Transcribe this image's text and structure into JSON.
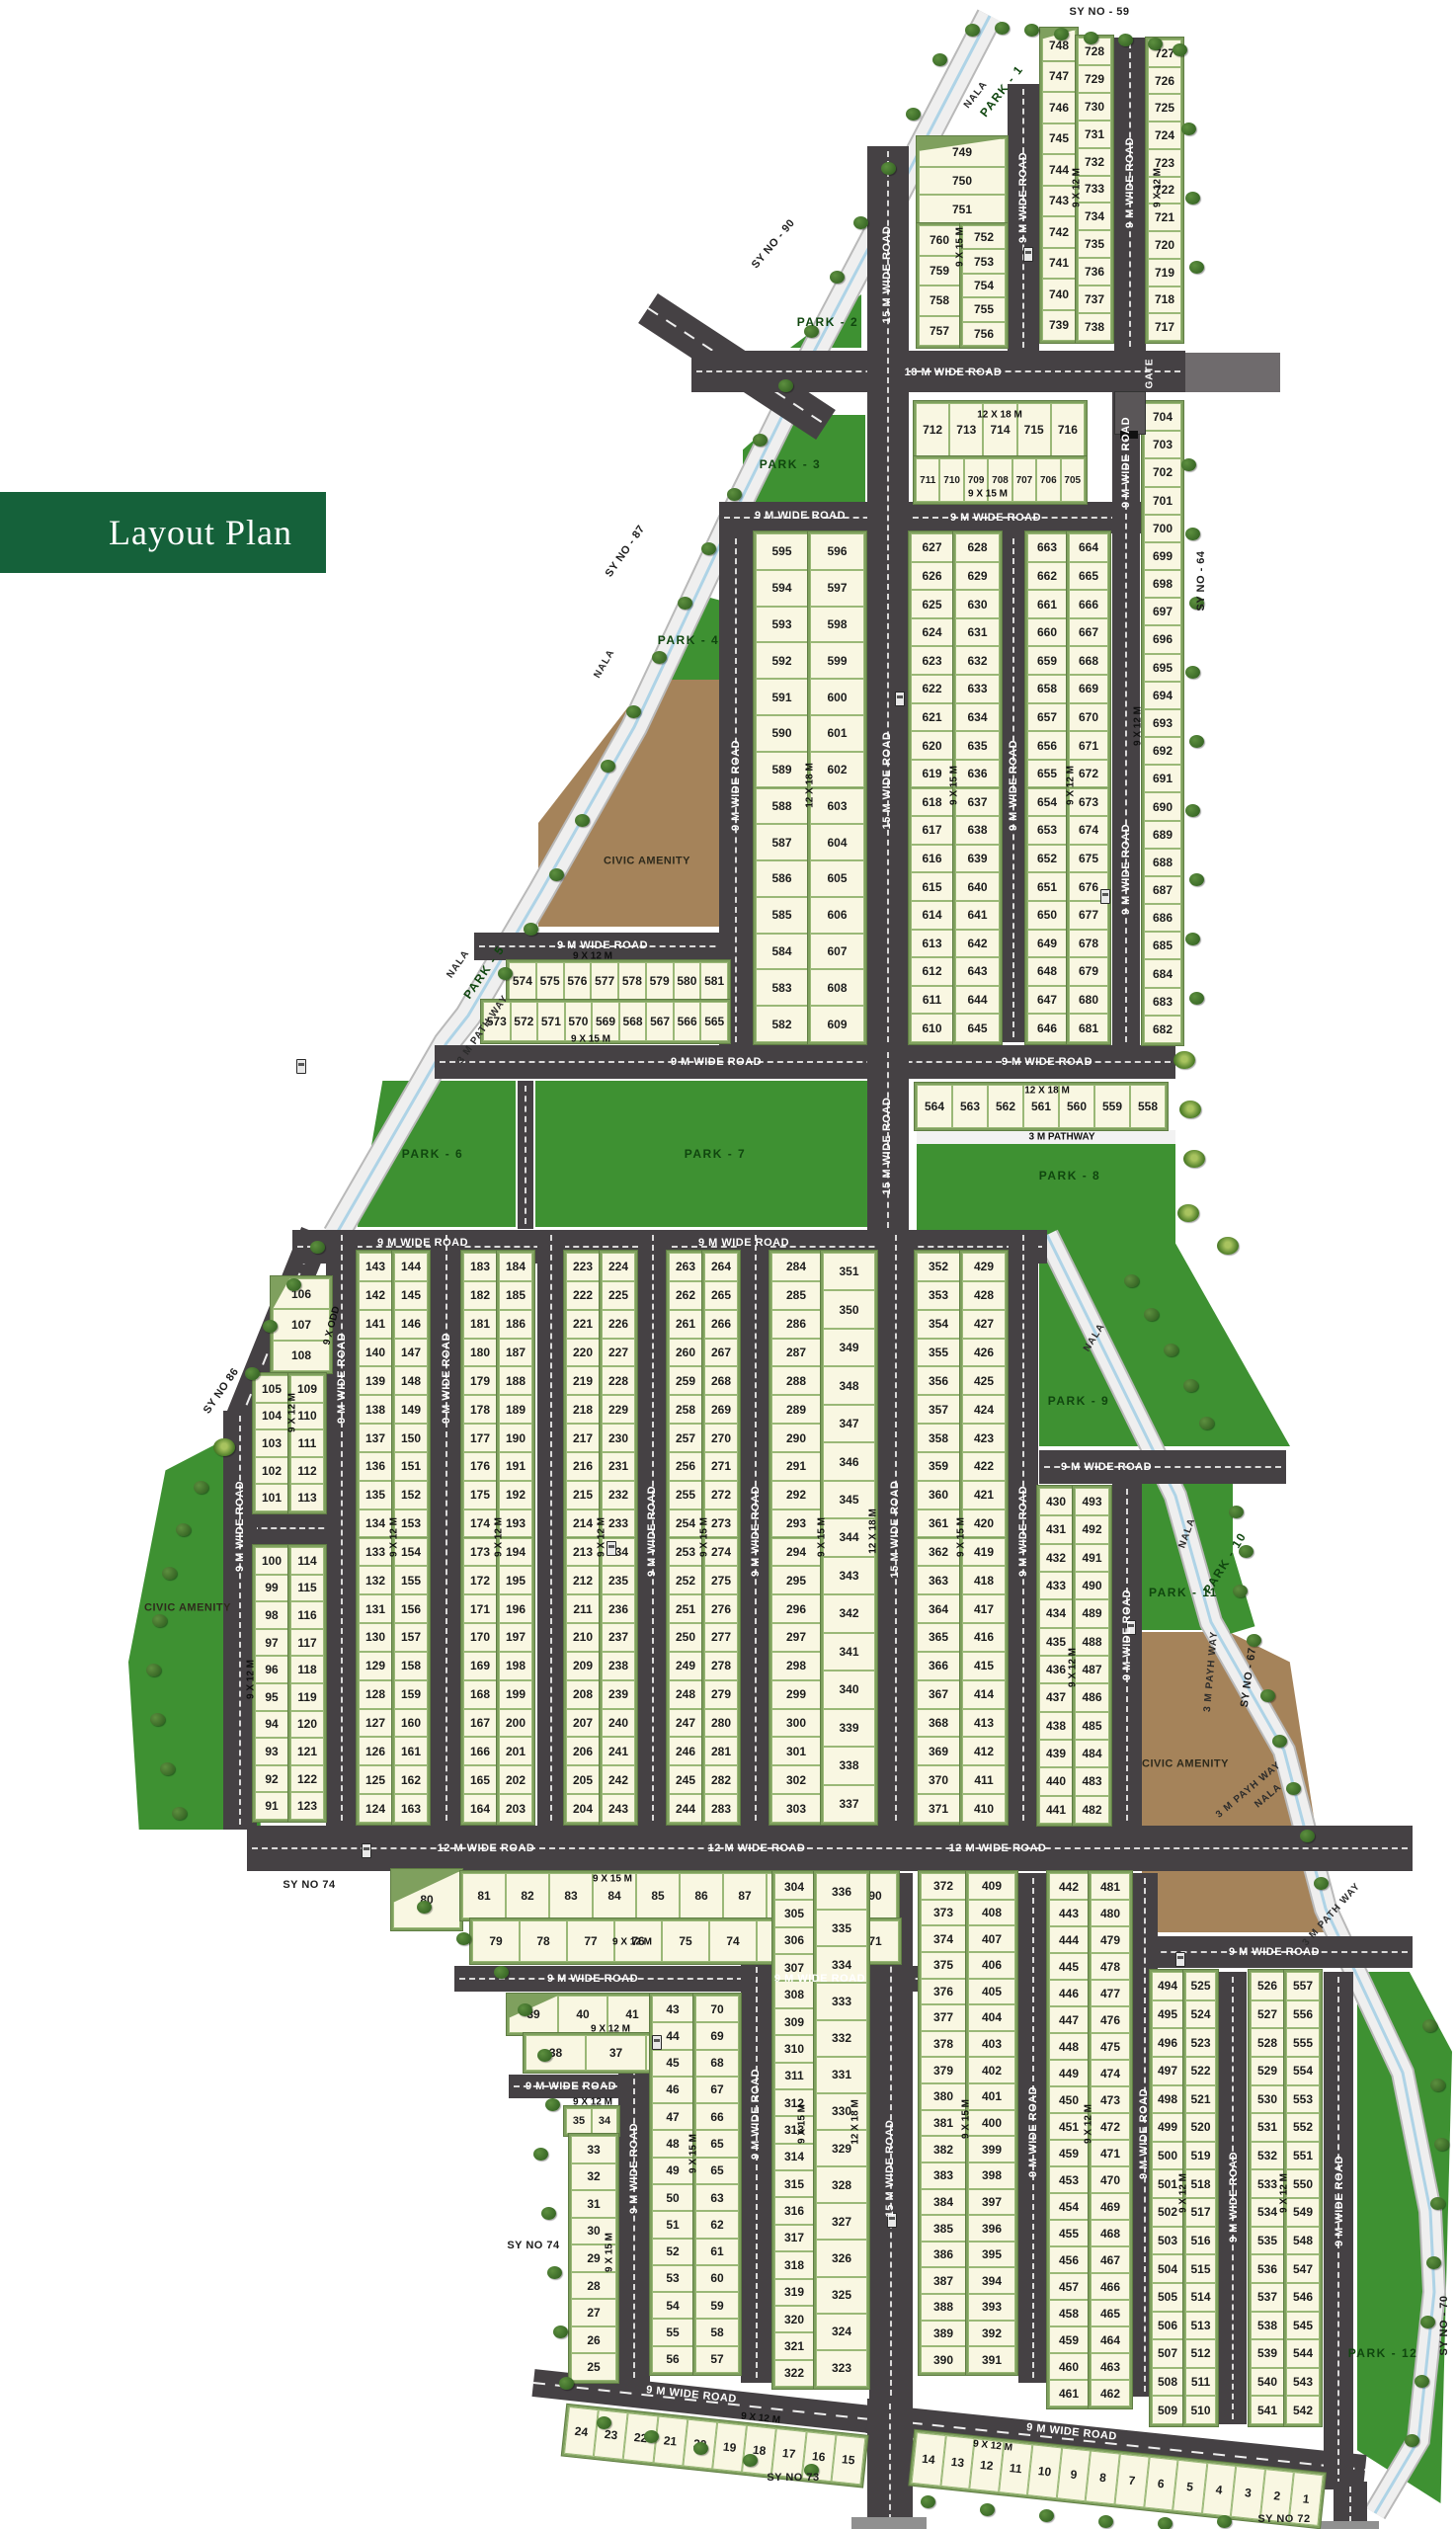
{
  "title": "Layout Plan",
  "roads": {
    "w9": "9 M WIDE ROAD",
    "w12": "12 M WIDE ROAD",
    "w15": "15 M WIDE ROAD",
    "w18": "18 M WIDE ROAD"
  },
  "dims": {
    "d912": "9 X 12 M",
    "d915": "9 X 15 M",
    "d1218": "12 X 18 M",
    "dodd": "9 X ODD"
  },
  "misc": {
    "gate": "GATE",
    "civic": "CIVIC AMENITY",
    "nala": "NALA",
    "pathway": "3 M PATHWAY",
    "pathway2": "3 M PATH WAY",
    "payh": "3 M PAYH WAY"
  },
  "parks": {
    "p1": "PARK - 1",
    "p2": "PARK - 2",
    "p3": "PARK - 3",
    "p4": "PARK - 4",
    "p5": "PARK - 5",
    "p6": "PARK - 6",
    "p7": "PARK - 7",
    "p8": "PARK - 8",
    "p9": "PARK - 9",
    "p10": "PARK - 10",
    "p11": "PARK - 11",
    "p12": "PARK - 12"
  },
  "survey": {
    "s59": "SY NO - 59",
    "s64": "SY NO - 64",
    "s67": "SY NO - 67",
    "s70": "SY NO - 70",
    "s72": "SY NO 72",
    "s73": "SY NO 73",
    "s74": "SY NO 74",
    "s86": "SY NO 86",
    "s87": "SY NO - 87",
    "s90": "SY NO - 90"
  },
  "blocks": {
    "b749": {
      "full": [
        749,
        750,
        751
      ],
      "left": [
        760,
        759,
        758,
        757
      ],
      "right": [
        752,
        753,
        754,
        755,
        756
      ]
    },
    "b728": {
      "left": [
        748,
        747,
        746,
        745,
        744,
        743,
        742,
        741,
        740,
        739
      ],
      "right": [
        728,
        729,
        730,
        731,
        732,
        733,
        734,
        735,
        736,
        737,
        738
      ]
    },
    "b717": {
      "col": [
        727,
        726,
        725,
        724,
        723,
        722,
        721,
        720,
        719,
        718,
        717
      ]
    },
    "b705": {
      "top": [
        712,
        713,
        714,
        715,
        716
      ],
      "bottom": [
        711,
        710,
        709,
        708,
        707,
        706,
        705
      ]
    },
    "b682": {
      "col": [
        704,
        703,
        702,
        701,
        700,
        699,
        698,
        697,
        696,
        695,
        694,
        693,
        692,
        691,
        690,
        689,
        688,
        687,
        686,
        685,
        684,
        683,
        682
      ]
    },
    "b582": {
      "left": [
        595,
        594,
        593,
        592,
        591,
        590,
        589,
        588,
        587,
        586,
        585,
        584,
        583,
        582
      ],
      "right": [
        596,
        597,
        598,
        599,
        600,
        601,
        602,
        603,
        604,
        605,
        606,
        607,
        608,
        609
      ]
    },
    "b610": {
      "left": [
        627,
        626,
        625,
        624,
        623,
        622,
        621,
        620,
        619,
        618,
        617,
        616,
        615,
        614,
        613,
        612,
        611,
        610
      ],
      "right": [
        628,
        629,
        630,
        631,
        632,
        633,
        634,
        635,
        636,
        637,
        638,
        639,
        640,
        641,
        642,
        643,
        644,
        645
      ]
    },
    "b646": {
      "left": [
        663,
        662,
        661,
        660,
        659,
        658,
        657,
        656,
        655,
        654,
        653,
        652,
        651,
        650,
        649,
        648,
        647,
        646
      ],
      "right": [
        664,
        665,
        666,
        667,
        668,
        669,
        670,
        671,
        672,
        673,
        674,
        675,
        676,
        677,
        678,
        679,
        680,
        681
      ]
    },
    "b565": {
      "top": [
        574,
        575,
        576,
        577,
        578,
        579,
        580,
        581
      ],
      "bottom": [
        573,
        572,
        571,
        570,
        569,
        568,
        567,
        566,
        565
      ]
    },
    "b558": {
      "row": [
        564,
        563,
        562,
        561,
        560,
        559,
        558
      ]
    },
    "b101": {
      "wedge": [
        106,
        107,
        108
      ],
      "upL": [
        105,
        104,
        103,
        102,
        101
      ],
      "upR": [
        109,
        110,
        111,
        112,
        113
      ],
      "loL": [
        100,
        99,
        98,
        97,
        96,
        95,
        94,
        93,
        92,
        91
      ],
      "loR": [
        114,
        115,
        116,
        117,
        118,
        119,
        120,
        121,
        122,
        123
      ]
    },
    "b124": {
      "left": [
        143,
        142,
        141,
        140,
        139,
        138,
        137,
        136,
        135,
        134,
        133,
        132,
        131,
        130,
        129,
        128,
        127,
        126,
        125,
        124
      ],
      "right": [
        144,
        145,
        146,
        147,
        148,
        149,
        150,
        151,
        152,
        153,
        154,
        155,
        156,
        157,
        158,
        159,
        160,
        161,
        162,
        163
      ]
    },
    "b164": {
      "left": [
        183,
        182,
        181,
        180,
        179,
        178,
        177,
        176,
        175,
        174,
        173,
        172,
        171,
        170,
        169,
        168,
        167,
        166,
        165,
        164
      ],
      "right": [
        184,
        185,
        186,
        187,
        188,
        189,
        190,
        191,
        192,
        193,
        194,
        195,
        196,
        197,
        198,
        199,
        200,
        201,
        202,
        203
      ]
    },
    "b204": {
      "left": [
        223,
        222,
        221,
        220,
        219,
        218,
        217,
        216,
        215,
        214,
        213,
        212,
        211,
        210,
        209,
        208,
        207,
        206,
        205,
        204
      ],
      "right": [
        224,
        225,
        226,
        227,
        228,
        229,
        230,
        231,
        232,
        233,
        234,
        235,
        236,
        237,
        238,
        239,
        240,
        241,
        242,
        243
      ]
    },
    "b244": {
      "left": [
        263,
        262,
        261,
        260,
        259,
        258,
        257,
        256,
        255,
        254,
        253,
        252,
        251,
        250,
        249,
        248,
        247,
        246,
        245,
        244
      ],
      "right": [
        264,
        265,
        266,
        267,
        268,
        269,
        270,
        271,
        272,
        273,
        274,
        275,
        276,
        277,
        278,
        279,
        280,
        281,
        282,
        283
      ]
    },
    "b284": {
      "left": [
        284,
        285,
        286,
        287,
        288,
        289,
        290,
        291,
        292,
        293,
        294,
        295,
        296,
        297,
        298,
        299,
        300,
        301,
        302,
        303
      ],
      "right": [
        351,
        350,
        349,
        348,
        347,
        346,
        345,
        344,
        343,
        342,
        341,
        340,
        339,
        338,
        337
      ]
    },
    "b352": {
      "left": [
        352,
        353,
        354,
        355,
        356,
        357,
        358,
        359,
        360,
        361,
        362,
        363,
        364,
        365,
        366,
        367,
        368,
        369,
        370,
        371
      ],
      "right": [
        429,
        428,
        427,
        426,
        425,
        424,
        423,
        422,
        421,
        420,
        419,
        418,
        417,
        416,
        415,
        414,
        413,
        412,
        411,
        410
      ]
    },
    "b430": {
      "left": [
        430,
        431,
        432,
        433,
        434,
        435,
        436,
        437,
        438,
        439,
        440,
        441
      ],
      "right": [
        493,
        492,
        491,
        490,
        489,
        488,
        487,
        486,
        485,
        484,
        483,
        482
      ]
    },
    "b71": {
      "wedge": [
        80
      ],
      "top": [
        81,
        82,
        83,
        84,
        85,
        86,
        87,
        88,
        89,
        90
      ],
      "bottom": [
        79,
        78,
        77,
        76,
        75,
        74,
        73,
        72,
        71
      ]
    },
    "b36": {
      "top": [
        39,
        40,
        41,
        42
      ],
      "bottom": [
        38,
        37,
        36
      ]
    },
    "b25": {
      "pair": [
        35,
        34
      ],
      "col": [
        33,
        32,
        31,
        30,
        29,
        28,
        27,
        26,
        25
      ]
    },
    "b43": {
      "left": [
        43,
        44,
        45,
        46,
        47,
        48,
        49,
        50,
        51,
        52,
        53,
        54,
        55,
        56
      ],
      "right": [
        70,
        69,
        68,
        67,
        66,
        65,
        65,
        63,
        62,
        61,
        60,
        59,
        58,
        57
      ]
    },
    "b304": {
      "left": [
        304,
        305,
        306,
        307,
        308,
        309,
        310,
        311,
        312,
        313,
        314,
        315,
        316,
        317,
        318,
        319,
        320,
        321,
        322
      ],
      "right": [
        336,
        335,
        334,
        333,
        332,
        331,
        330,
        329,
        328,
        327,
        326,
        325,
        324,
        323
      ]
    },
    "b372": {
      "left": [
        372,
        373,
        374,
        375,
        376,
        377,
        378,
        379,
        380,
        381,
        382,
        383,
        384,
        385,
        386,
        387,
        388,
        389,
        390
      ],
      "right": [
        409,
        408,
        407,
        406,
        405,
        404,
        403,
        402,
        401,
        400,
        399,
        398,
        397,
        396,
        395,
        394,
        393,
        392,
        391
      ]
    },
    "b442": {
      "left": [
        442,
        443,
        444,
        445,
        446,
        447,
        448,
        449,
        450,
        451,
        459,
        453,
        454,
        455,
        456,
        457,
        458,
        459,
        460,
        461
      ],
      "right": [
        481,
        480,
        479,
        478,
        477,
        476,
        475,
        474,
        473,
        472,
        471,
        470,
        469,
        468,
        467,
        466,
        465,
        464,
        463,
        462
      ]
    },
    "b494": {
      "left": [
        494,
        495,
        496,
        497,
        498,
        499,
        500,
        501,
        502,
        503,
        504,
        505,
        506,
        507,
        508,
        509
      ],
      "right": [
        525,
        524,
        523,
        522,
        521,
        520,
        519,
        518,
        517,
        516,
        515,
        514,
        513,
        512,
        511,
        510
      ]
    },
    "b526": {
      "left": [
        526,
        527,
        528,
        529,
        530,
        531,
        532,
        533,
        534,
        535,
        536,
        537,
        538,
        539,
        540,
        541
      ],
      "right": [
        557,
        556,
        555,
        554,
        553,
        552,
        551,
        550,
        549,
        548,
        547,
        546,
        545,
        544,
        543,
        542
      ]
    },
    "b15": {
      "row": [
        24,
        23,
        22,
        21,
        20,
        19,
        18,
        17,
        16,
        15
      ]
    },
    "b1": {
      "row": [
        14,
        13,
        12,
        11,
        10,
        9,
        8,
        7,
        6,
        5,
        4,
        3,
        2,
        1
      ]
    }
  }
}
